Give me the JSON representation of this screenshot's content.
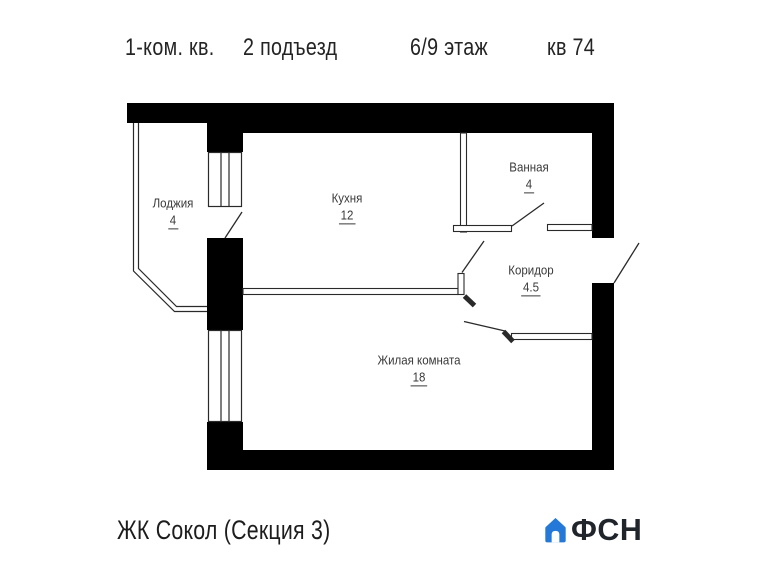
{
  "header": {
    "apartment_type": "1-ком. кв.",
    "entrance": "2 подъезд",
    "floor": "6/9 этаж",
    "unit": "кв 74"
  },
  "rooms": [
    {
      "name": "Лоджия",
      "area": "4"
    },
    {
      "name": "Кухня",
      "area": "12"
    },
    {
      "name": "Ванная",
      "area": "4"
    },
    {
      "name": "Коридор",
      "area": "4.5"
    },
    {
      "name": "Жилая комната",
      "area": "18"
    }
  ],
  "footer": {
    "project": "ЖК Сокол (Секция 3)",
    "brand": "ФСН"
  },
  "icons": {
    "logo_icon": "house-icon"
  },
  "colors": {
    "walls": "#000000",
    "thin_lines": "#2a2a2a",
    "label_text": "#3a3a3a",
    "brand_blue": "#2478d8",
    "brand_text": "#20242b"
  }
}
